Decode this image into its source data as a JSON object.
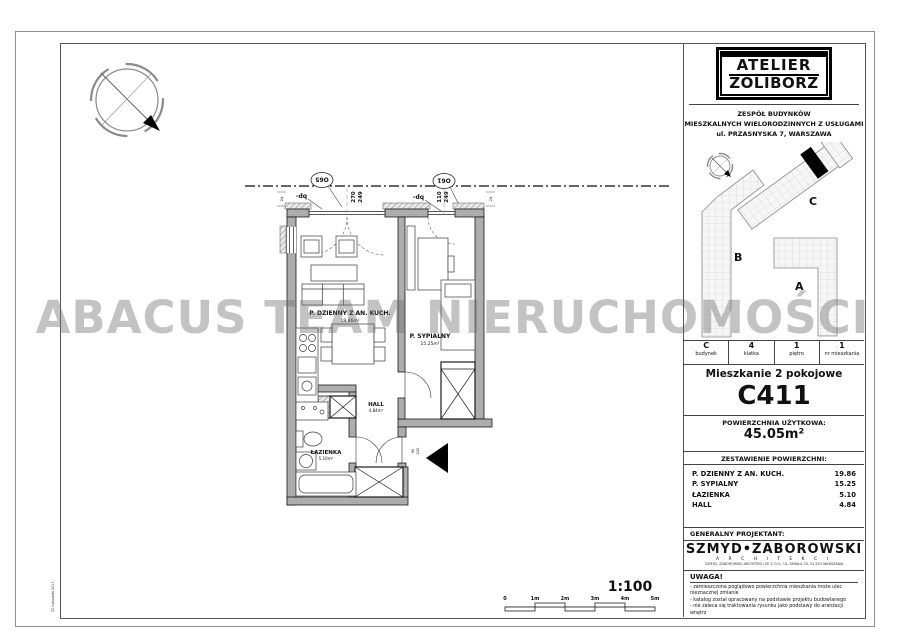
{
  "watermark": "ABACUS TEAM NIERUCHOMOŚCI",
  "colors": {
    "watermark": "#9a9a9a",
    "wall_fill": "#adadad",
    "marker": "#000000"
  },
  "sheet": {
    "scale": "1:100",
    "scale_ticks": [
      "0",
      "1m",
      "2m",
      "3m",
      "4m",
      "5m"
    ],
    "margin_note": "22 listopada 2011"
  },
  "plan": {
    "rooms": [
      {
        "name": "P. DZIENNY Z AN. KUCH.",
        "area": "19.86m²"
      },
      {
        "name": "P. SYPIALNY",
        "area": "15.25m²"
      },
      {
        "name": "HALL",
        "area": "4.84m²"
      },
      {
        "name": "ŁAZIENKA",
        "area": "5.10m²"
      }
    ],
    "windows": [
      {
        "ref": "O65",
        "width": "270",
        "sill": "249"
      },
      {
        "ref": "O61",
        "width": "110",
        "sill": "249"
      }
    ],
    "wall_note": "-dq",
    "corner_dim": "24",
    "door_width": "90",
    "door_height": "200"
  },
  "panel": {
    "logo": {
      "line1": "ATELIER",
      "line2": "ŻOLIBORZ"
    },
    "project_line1": "ZESPÓŁ BUDYNKÓW",
    "project_line2": "MIESZKALNYCH WIELORODZINNYCH Z USŁUGAMI",
    "project_line3": "ul. PRZASNYSKA 7,   WARSZAWA",
    "site": {
      "building_a": "A",
      "building_b": "B",
      "building_c": "C"
    },
    "unit": [
      {
        "value": "C",
        "label": "budynek"
      },
      {
        "value": "4",
        "label": "klatka"
      },
      {
        "value": "1",
        "label": "piętro"
      },
      {
        "value": "1",
        "label": "nr mieszkania"
      }
    ],
    "apartment_type": "Mieszkanie 2 pokojowe",
    "apartment_id": "C411",
    "area_label": "POWIERZCHNIA UŻYTKOWA:",
    "area_value": "45.05m²",
    "breakdown_label": "ZESTAWIENIE POWIERZCHNI:",
    "room_rows": [
      {
        "name": "P. DZIENNY Z AN. KUCH.",
        "value": "19.86"
      },
      {
        "name": "P. SYPIALNY",
        "value": "15.25"
      },
      {
        "name": "ŁAZIENKA",
        "value": "5.10"
      },
      {
        "name": "HALL",
        "value": "4.84"
      }
    ],
    "designer_label": "GENERALNY PROJEKTANT:",
    "designer_name": "SZMYD•ZABOROWSKI",
    "designer_sub": "A R C H I T E K C I",
    "designer_address": "SZMYD, ZABOROWSKI ARCHITEKCI SP. Z O.O., UL. ŚMIAŁA 30, 01-523 WARSZAWA",
    "notice_title": "UWAGA!",
    "notices": [
      "- zamieszczona poglądowo powierzchnia mieszkania może ulec nieznacznej zmianie",
      "- katalog został opracowany na podstawie projektu budowlanego",
      "- nie zaleca się traktowania rysunku jako podstawy do aranżacji wnętrz"
    ]
  }
}
